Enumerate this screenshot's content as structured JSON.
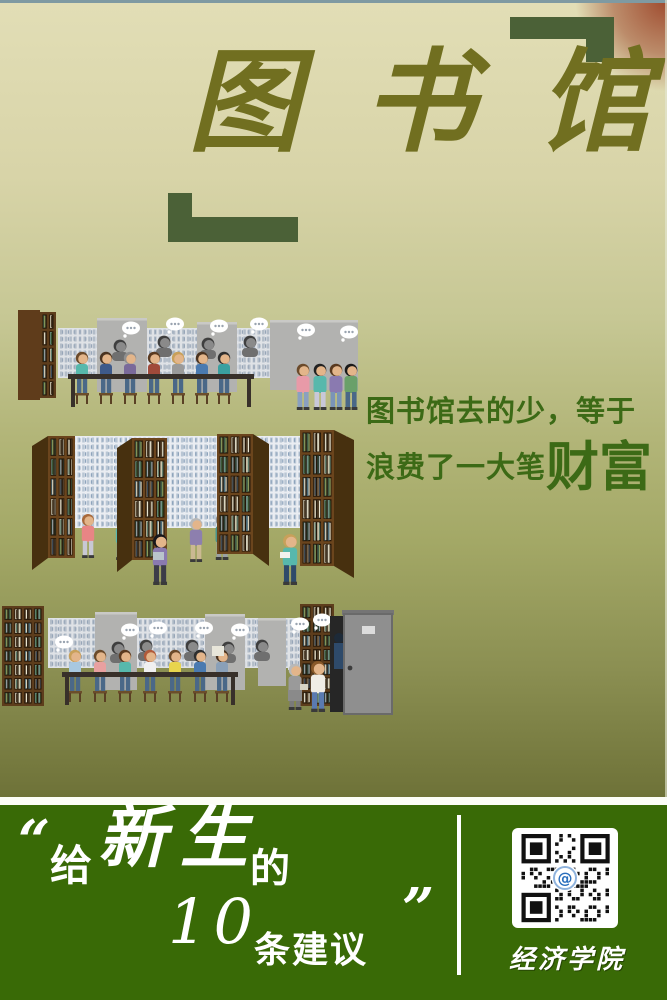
{
  "title": {
    "c1": "图",
    "c2": "书",
    "c3": "馆"
  },
  "tagline": {
    "line1": "图书馆去的少，等于",
    "line2_prefix": "浪费了一大笔",
    "line2_emphasis": "财富"
  },
  "banner": {
    "open_quote": "“",
    "give": "给",
    "freshmen": "新生",
    "de": "的",
    "number": "10",
    "suggestions": "条建议",
    "close_quote": "”",
    "org": "经济学院"
  },
  "icons": {
    "qr_code": "qr-code",
    "qr_center_logo": "@",
    "bracket_top_right": "corner-bracket",
    "bracket_bottom_left": "corner-bracket"
  },
  "colors": {
    "banner_green": "#396a06",
    "title_olive": "#716f20",
    "tagline_green": "#3c6a16",
    "bracket_green": "#4b6137",
    "corner_glow_red": "#9e4a2e"
  }
}
